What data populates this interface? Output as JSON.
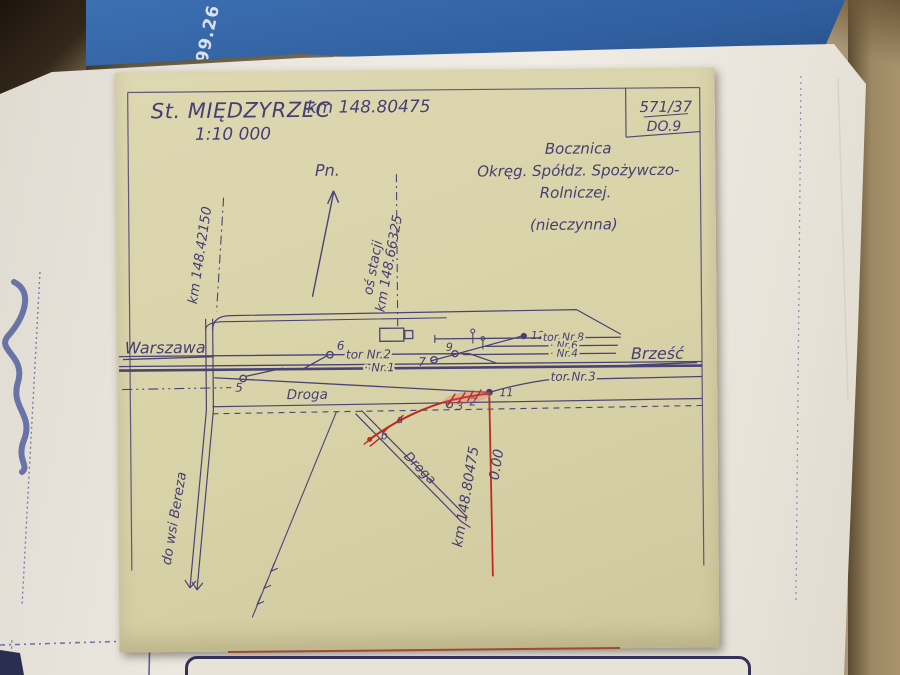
{
  "photo": {
    "blue_code": "299.26"
  },
  "sheet": {
    "ref": {
      "num": "571/37",
      "code": "DO.9"
    },
    "title": {
      "station": "St. MIĘDZYRZEC",
      "km": "km 148.80475",
      "scale": "1:10 000"
    },
    "note": {
      "l1": "Bocznica",
      "l2": "Okręg. Spółdz. Spożywczo-",
      "l3": "Rolniczej.",
      "l4": "(nieczynna)"
    },
    "north": "Pn.",
    "axis": {
      "name": "oś stacji",
      "km": "km 148.66325"
    },
    "km_marker": "km 148.42150",
    "directions": {
      "left": "Warszawa",
      "right": "Brześć"
    },
    "tracks": {
      "nr2": "tor Nr.2",
      "nr1": "· Nr.1",
      "nr3": "tor Nr.3",
      "nr8": "tor Nr.8",
      "nr6": "· Nr.6",
      "nr4": "· Nr.4"
    },
    "roads": {
      "main": "Droga",
      "branch": "Droga",
      "village": "do wsi Bereza"
    },
    "red": {
      "km": "km 148.80475",
      "zero": "0.00"
    },
    "points": {
      "p5": "5",
      "p6": "6",
      "p7": "7",
      "p9": "9",
      "p12": "12",
      "p11": "11",
      "p2": "2",
      "p3": "3",
      "pa": "a",
      "pb": "b"
    }
  }
}
